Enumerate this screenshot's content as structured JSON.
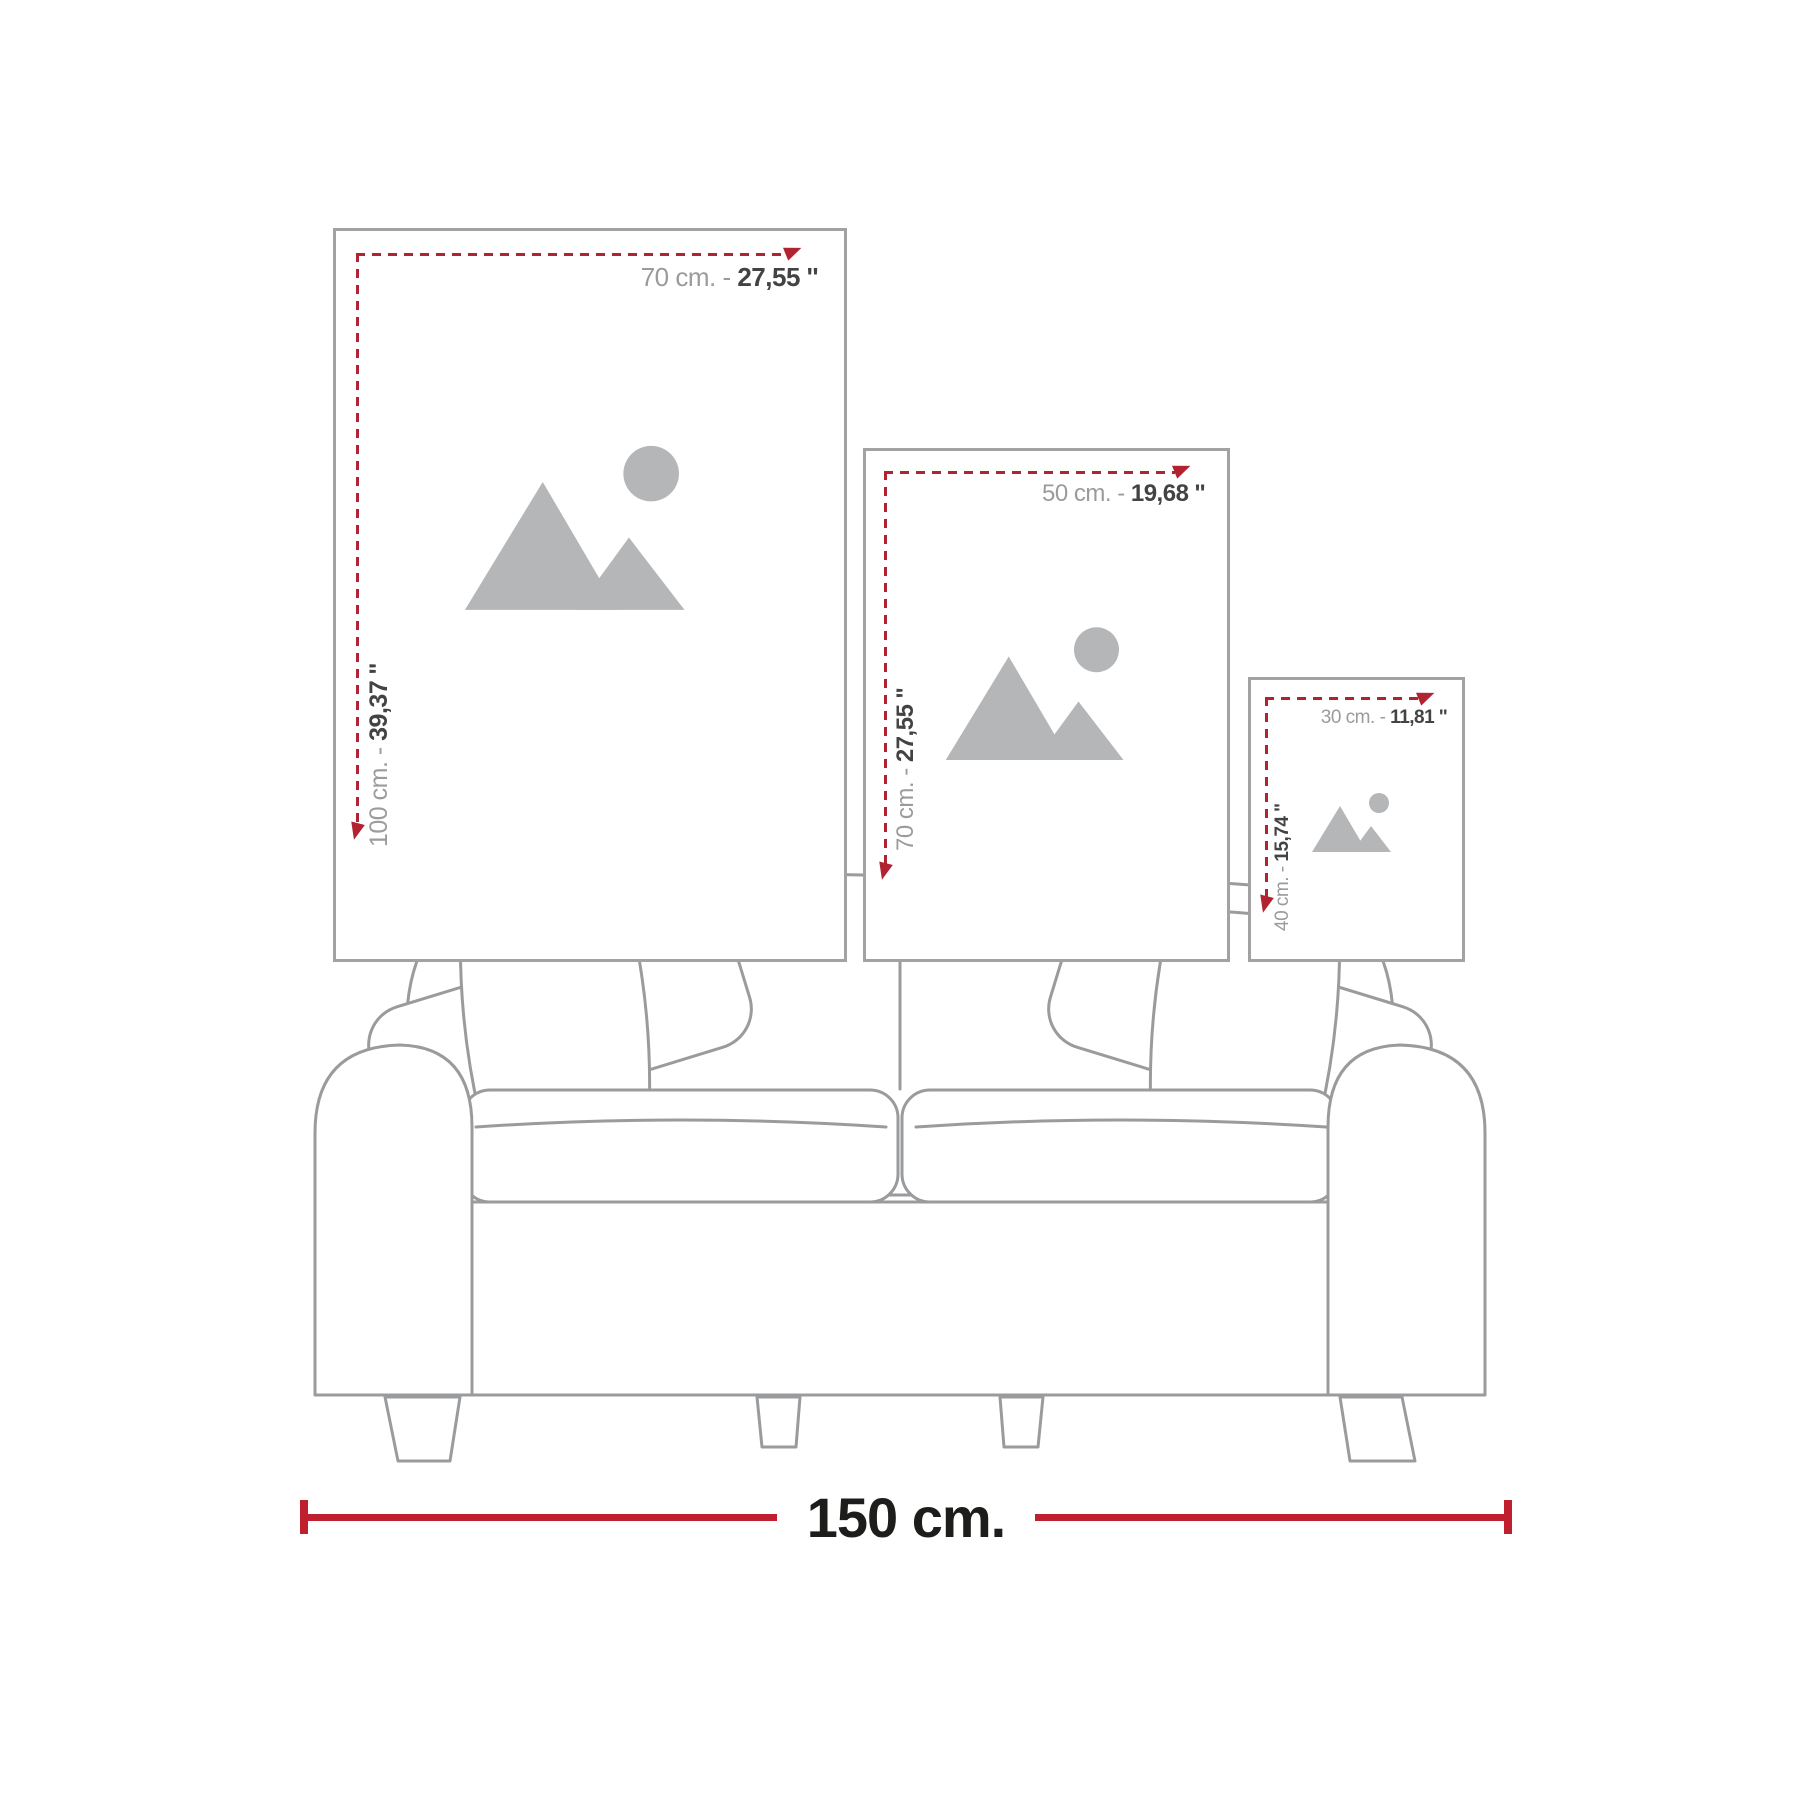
{
  "colors": {
    "measure_red": "#c01f2e",
    "dash_red": "#b22332",
    "frame_border": "#a2a2a2",
    "label_gray": "#9b9b9b",
    "label_dark": "#434343",
    "art_gray": "#b5b6b8",
    "sofa_line": "#9a9b9d",
    "bottom_text": "#1d1d1b"
  },
  "frames": [
    {
      "name": "poster 70x100",
      "width_cm": "70 cm. - ",
      "width_in": "27,55 ''",
      "height_cm": "100 cm. - ",
      "height_in": "39,37 ''"
    },
    {
      "name": "poster 50x70",
      "width_cm": "50 cm. - ",
      "width_in": "19,68 ''",
      "height_cm": "70 cm. - ",
      "height_in": "27,55 ''"
    },
    {
      "name": "poster 30x40",
      "width_cm": "30 cm. - ",
      "width_in": "11,81 ''",
      "height_cm": "40 cm. - ",
      "height_in": "15,74 ''"
    }
  ],
  "sofa": {
    "width_label": "150 cm."
  },
  "icons": {
    "placeholder": "mountains-sun image placeholder",
    "h_arrow": "red arrow pointing right",
    "v_arrow": "red arrow pointing down"
  }
}
